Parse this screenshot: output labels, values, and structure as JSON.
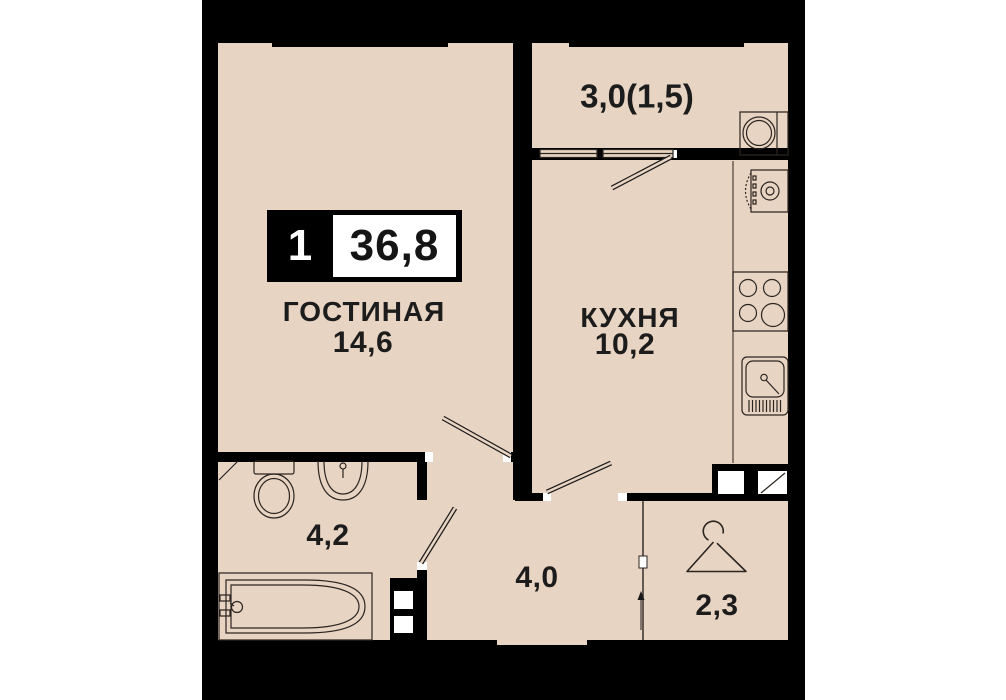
{
  "badge": {
    "room_count": "1",
    "total_area": "36,8"
  },
  "rooms": {
    "living": {
      "name": "ГОСТИНАЯ",
      "area": "14,6"
    },
    "kitchen": {
      "name": "КУХНЯ",
      "area": "10,2"
    },
    "balcony": {
      "area": "3,0(1,5)"
    },
    "bathroom": {
      "area": "4,2"
    },
    "hallway": {
      "area": "4,0"
    },
    "wardrobe": {
      "area": "2,3"
    }
  },
  "icons": [
    "toilet-icon",
    "bath-sink-icon",
    "bathtub-icon",
    "hanger-icon",
    "stove-icon",
    "kitchen-sink-icon",
    "oven-icon",
    "washing-machine-icon"
  ],
  "colors": {
    "floor": "#e8d4c3",
    "wall": "#000000",
    "paper": "#ffffff",
    "ink": "#1c1c1c"
  }
}
